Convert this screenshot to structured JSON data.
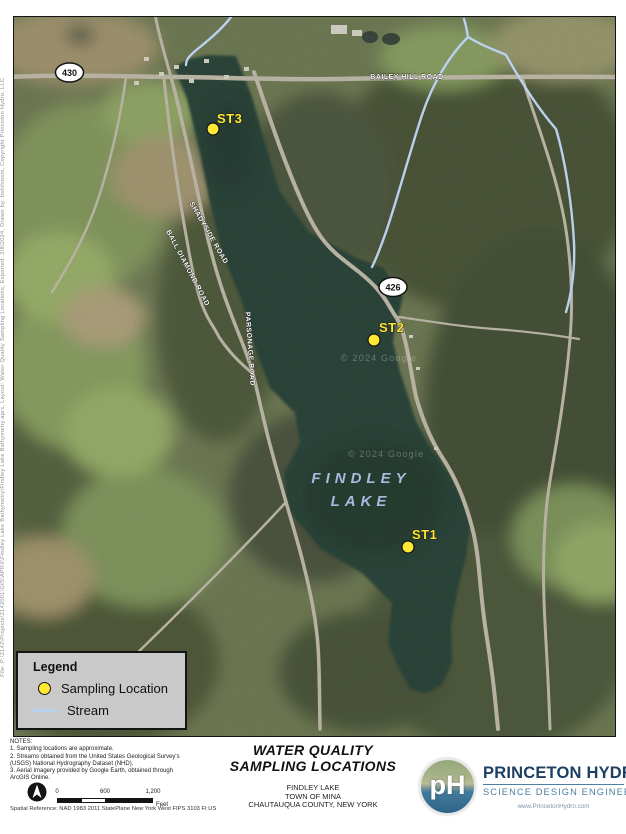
{
  "sidebar": {
    "file_info": "File: P:\\2142\\Projects\\2142001\\GIS\\APRX\\Findley Lake Bathymetry\\Findley Lake Bathymetry.aprx, Layout: Water Quality Sampling Locations, Exported: 2/8/2024, Drawn by: bshilvosm, Copyright Princeton Hydro, LLC."
  },
  "map": {
    "shields": [
      {
        "route": "430"
      },
      {
        "route": "426"
      }
    ],
    "road_labels": [
      {
        "text": "BAILEY HILL ROAD"
      },
      {
        "text": "SHADYSIDE ROAD"
      },
      {
        "text": "BALL DIAMOND ROAD"
      },
      {
        "text": "PARSONAGE ROAD"
      }
    ],
    "lake_name_line1": "FINDLEY",
    "lake_name_line2": "LAKE",
    "stations": [
      {
        "id": "ST1"
      },
      {
        "id": "ST2"
      },
      {
        "id": "ST3"
      }
    ],
    "imagery_credit": "© 2024 Google"
  },
  "legend": {
    "title": "Legend",
    "sampling_label": "Sampling Location",
    "stream_label": "Stream"
  },
  "notes": {
    "lines": [
      "NOTES:",
      "1. Sampling locations are approximate.",
      "2. Streams obtained from the United States Geological Survey's",
      "(USGS) National Hydrography Dataset (NHD).",
      "3. Aerial Imagery provided by Google Earth, obtained through",
      "ArcGIS Online."
    ]
  },
  "scale_bar": {
    "ticks": [
      "0",
      "600",
      "1,200"
    ],
    "unit": "Feet"
  },
  "spatial_reference": "Spatial Reference: NAD 1983 2011 StatePlane New York West FIPS 3103 Ft US",
  "title_block": {
    "line1": "WATER QUALITY",
    "line2": "SAMPLING LOCATIONS",
    "sub1": "FINDLEY LAKE",
    "sub2": "TOWN OF MINA",
    "sub3": "CHAUTAUQUA COUNTY, NEW YORK"
  },
  "logo": {
    "monogram": "pH",
    "company": "PRINCETON HYDRO",
    "tagline": "SCIENCE DESIGN ENGINEERING",
    "website": "www.PrincetonHydro.com"
  },
  "colors": {
    "sampling_point": "#ffe833",
    "stream": "#bad0ee",
    "lake": "#243d34",
    "lake_label": "#a5bcdf",
    "legend_bg": "#c9c9c9",
    "logo_navy": "#1c3f63",
    "logo_teal": "#4e7fa0"
  }
}
